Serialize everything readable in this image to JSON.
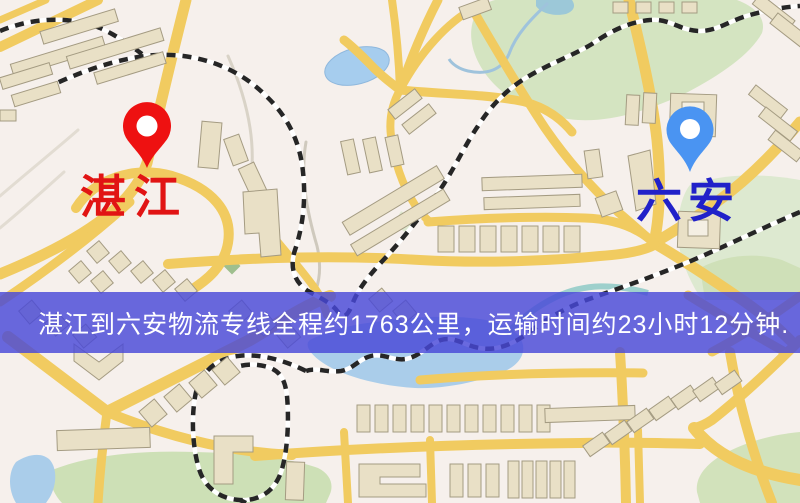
{
  "map": {
    "origin_label": "湛江",
    "destination_label": "六安",
    "origin_pin_color": "#ee1111",
    "destination_pin_color": "#4a94f2",
    "origin_label_color": "#e11414",
    "destination_label_color": "#2121c9"
  },
  "banner": {
    "text": "湛江到六安物流专线全程约1763公里，运输时间约23小时12分钟.",
    "background": "#4848d8",
    "text_color": "#ffffff"
  },
  "route": {
    "origin": "湛江",
    "destination": "六安",
    "distance_text": "约1763公里",
    "duration_text": "约23小时12分钟"
  }
}
